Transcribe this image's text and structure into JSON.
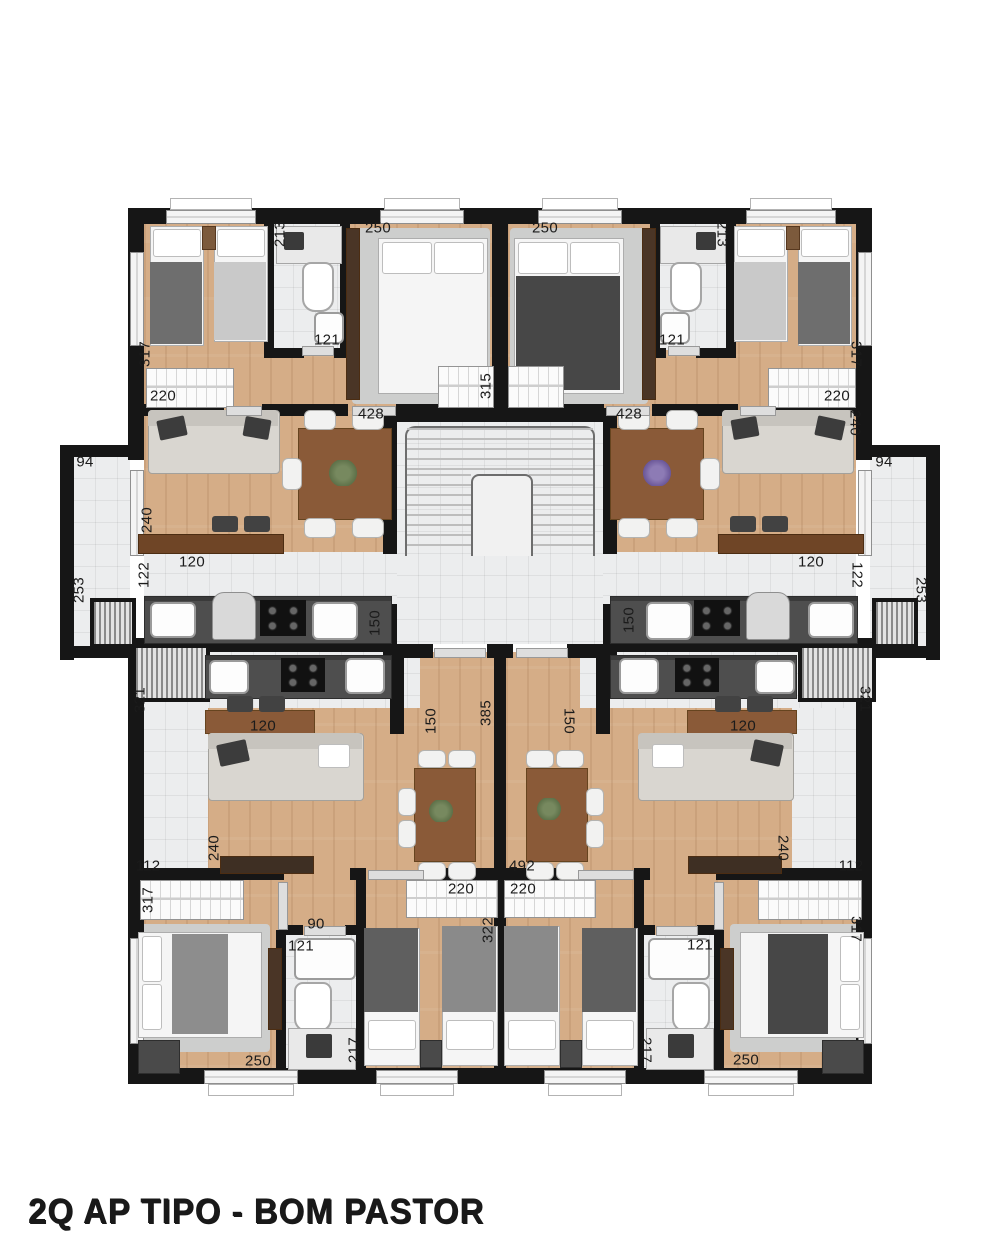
{
  "title": "2Q AP TIPO - BOM PASTOR",
  "colors": {
    "wall": "#161616",
    "wood_floor": "#d5ad87",
    "tile_floor": "#ecedee",
    "rug": "#cdcecd",
    "counter": "#4e4e4e",
    "furniture_wood": "#8a5a38",
    "label": "#1b1b1b",
    "background": "#ffffff"
  },
  "plan": {
    "labels": [
      {
        "text": "250",
        "x": 378,
        "y": 228,
        "rot": 0
      },
      {
        "text": "213",
        "x": 280,
        "y": 234,
        "rot": -90
      },
      {
        "text": "121",
        "x": 327,
        "y": 340,
        "rot": 0
      },
      {
        "text": "317",
        "x": 145,
        "y": 354,
        "rot": -90
      },
      {
        "text": "220",
        "x": 163,
        "y": 396,
        "rot": 0
      },
      {
        "text": "428",
        "x": 371,
        "y": 414,
        "rot": 0
      },
      {
        "text": "315",
        "x": 486,
        "y": 386,
        "rot": -90
      },
      {
        "text": "94",
        "x": 85,
        "y": 462,
        "rot": 0
      },
      {
        "text": "240",
        "x": 147,
        "y": 520,
        "rot": -90
      },
      {
        "text": "120",
        "x": 192,
        "y": 562,
        "rot": 0
      },
      {
        "text": "122",
        "x": 144,
        "y": 575,
        "rot": -90
      },
      {
        "text": "253",
        "x": 79,
        "y": 590,
        "rot": -90
      },
      {
        "text": "150",
        "x": 375,
        "y": 623,
        "rot": -90
      },
      {
        "text": "250",
        "x": 545,
        "y": 228,
        "rot": 0
      },
      {
        "text": "213",
        "x": 722,
        "y": 234,
        "rot": 90
      },
      {
        "text": "121",
        "x": 672,
        "y": 340,
        "rot": 0
      },
      {
        "text": "317",
        "x": 856,
        "y": 354,
        "rot": 90
      },
      {
        "text": "220",
        "x": 837,
        "y": 396,
        "rot": 0
      },
      {
        "text": "428",
        "x": 629,
        "y": 414,
        "rot": 0
      },
      {
        "text": "240",
        "x": 855,
        "y": 423,
        "rot": 90
      },
      {
        "text": "94",
        "x": 884,
        "y": 462,
        "rot": 0
      },
      {
        "text": "120",
        "x": 811,
        "y": 562,
        "rot": 0
      },
      {
        "text": "122",
        "x": 857,
        "y": 575,
        "rot": 90
      },
      {
        "text": "253",
        "x": 921,
        "y": 590,
        "rot": 90
      },
      {
        "text": "150",
        "x": 629,
        "y": 620,
        "rot": -90
      },
      {
        "text": "321",
        "x": 140,
        "y": 700,
        "rot": -90
      },
      {
        "text": "150",
        "x": 431,
        "y": 721,
        "rot": -90
      },
      {
        "text": "385",
        "x": 486,
        "y": 713,
        "rot": -90
      },
      {
        "text": "150",
        "x": 569,
        "y": 721,
        "rot": 90
      },
      {
        "text": "321",
        "x": 865,
        "y": 699,
        "rot": 90
      },
      {
        "text": "120",
        "x": 263,
        "y": 726,
        "rot": 0
      },
      {
        "text": "120",
        "x": 743,
        "y": 726,
        "rot": 0
      },
      {
        "text": "240",
        "x": 214,
        "y": 848,
        "rot": -90
      },
      {
        "text": "112",
        "x": 148,
        "y": 866,
        "rot": 0
      },
      {
        "text": "240",
        "x": 783,
        "y": 848,
        "rot": 90
      },
      {
        "text": "112",
        "x": 851,
        "y": 866,
        "rot": 0
      },
      {
        "text": "492",
        "x": 522,
        "y": 866,
        "rot": 0
      },
      {
        "text": "220",
        "x": 461,
        "y": 889,
        "rot": 0
      },
      {
        "text": "220",
        "x": 523,
        "y": 889,
        "rot": 0
      },
      {
        "text": "322",
        "x": 488,
        "y": 930,
        "rot": -90
      },
      {
        "text": "317",
        "x": 148,
        "y": 900,
        "rot": -90
      },
      {
        "text": "90",
        "x": 316,
        "y": 924,
        "rot": 0
      },
      {
        "text": "121",
        "x": 301,
        "y": 946,
        "rot": 0
      },
      {
        "text": "217",
        "x": 354,
        "y": 1050,
        "rot": -90
      },
      {
        "text": "250",
        "x": 258,
        "y": 1061,
        "rot": 0
      },
      {
        "text": "121",
        "x": 700,
        "y": 945,
        "rot": 0
      },
      {
        "text": "217",
        "x": 646,
        "y": 1050,
        "rot": 90
      },
      {
        "text": "250",
        "x": 746,
        "y": 1060,
        "rot": 0
      },
      {
        "text": "317",
        "x": 856,
        "y": 929,
        "rot": 90
      }
    ]
  }
}
